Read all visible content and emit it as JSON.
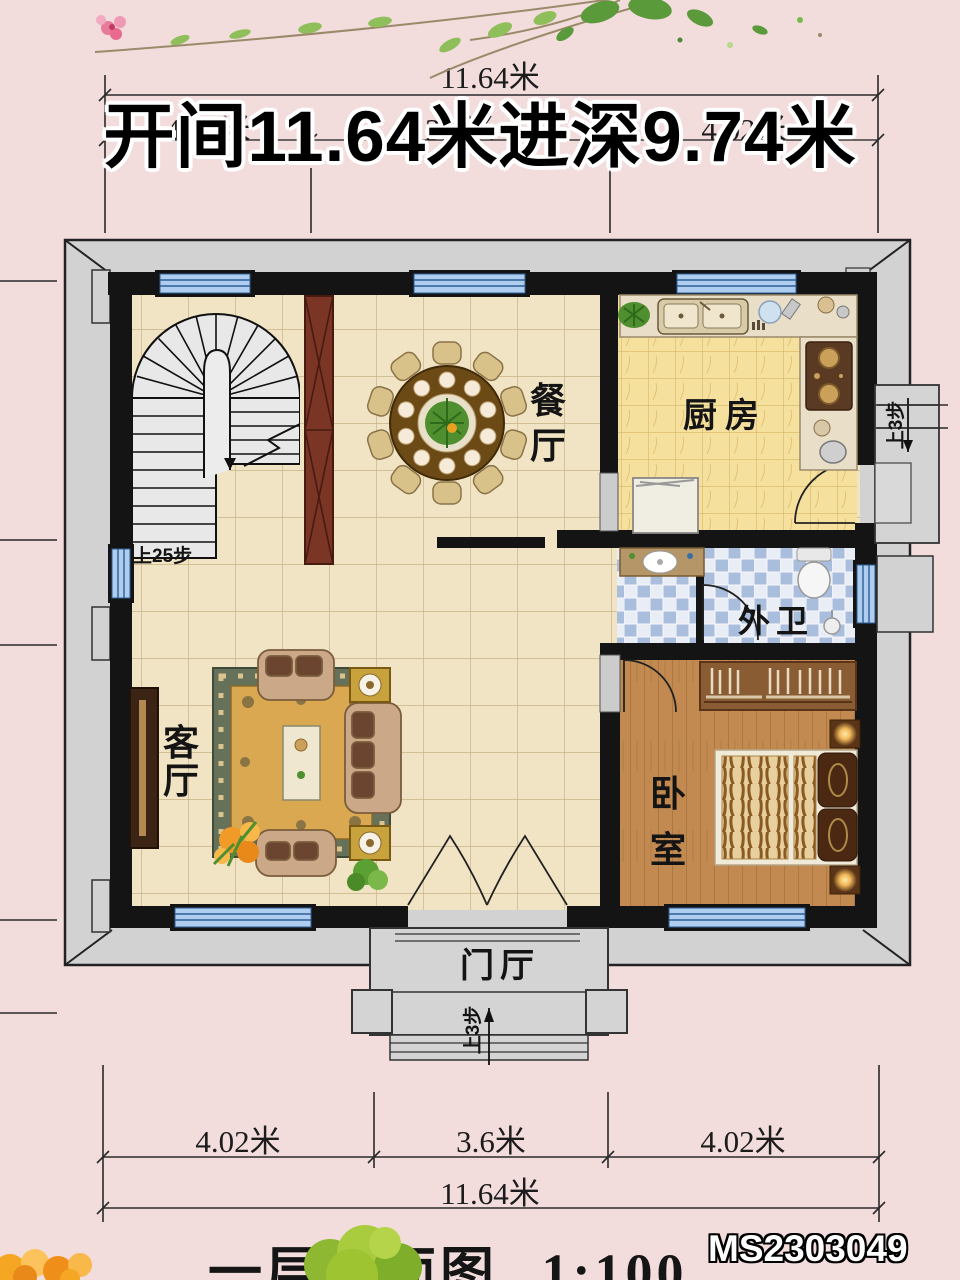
{
  "header": {
    "title": "开间11.64米进深9.74米",
    "top_dimension_total": "11.64米",
    "top_dimension_segments": [
      "4.02米",
      "3.6米",
      "4.02米"
    ]
  },
  "plan": {
    "rooms": [
      {
        "id": "dining",
        "label": "餐厅"
      },
      {
        "id": "kitchen",
        "label": "厨房"
      },
      {
        "id": "living",
        "label": "客厅"
      },
      {
        "id": "bedroom",
        "label": "卧室"
      },
      {
        "id": "bathroom",
        "label": "外卫"
      },
      {
        "id": "foyer",
        "label": "门厅"
      }
    ],
    "stairs_label": "上25步",
    "side_steps_label": "上3步",
    "porch_steps_label": "上3步"
  },
  "dimensions_bottom": {
    "segments": [
      "4.02米",
      "3.6米",
      "4.02米"
    ],
    "total": "11.64米"
  },
  "footer": {
    "drawing_title": "一层平面图",
    "scale": "1:100",
    "watermark": "MS2303049"
  },
  "colors": {
    "background_pink": "#f2dcdc",
    "wall_black": "#141414",
    "band_gray": "#d2d2d2",
    "window_blue": "#aecdef",
    "tile_beige": "#f1e4c4",
    "kitchen_yellow": "#f6e09e",
    "bath_blue": "#a9bddc",
    "wood_brown": "#c28a50",
    "rug_gold": "#d9a851"
  }
}
